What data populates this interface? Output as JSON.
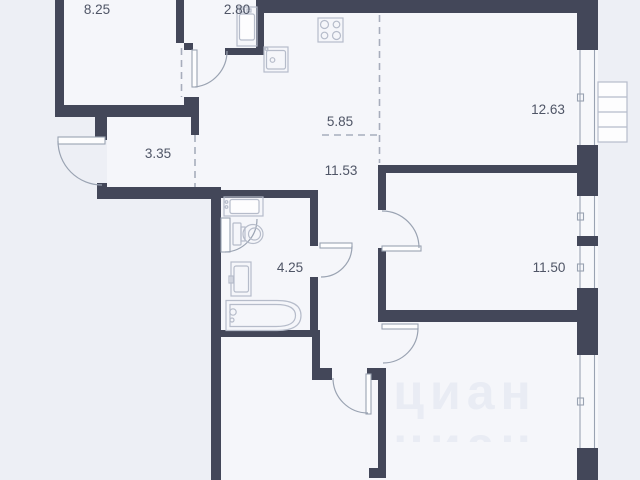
{
  "plan": {
    "title": "apartment-floor-plan",
    "watermark": "циан",
    "rooms": {
      "room_8_25": "8.25",
      "room_2_80": "2.80",
      "kitchen_5_85": "5.85",
      "living_12_63": "12.63",
      "hall_3_35": "3.35",
      "corridor_11_53": "11.53",
      "bathroom_4_25": "4.25",
      "bedroom_11_50": "11.50"
    },
    "fixtures": [
      "washing-machine",
      "stove",
      "kitchen-sink",
      "toilet",
      "bathroom-sink",
      "bathtub",
      "balcony-unit",
      "windows",
      "door-arcs"
    ],
    "colors": {
      "wall": "#434759",
      "interior": "#f5f6fa",
      "exterior": "#edeff5",
      "fixture_outline": "#b6bcca",
      "door_arc": "#9aa3b2",
      "dashed_line": "#a7adbc",
      "label": "#4f5566",
      "watermark": "#e9ecf4"
    }
  }
}
